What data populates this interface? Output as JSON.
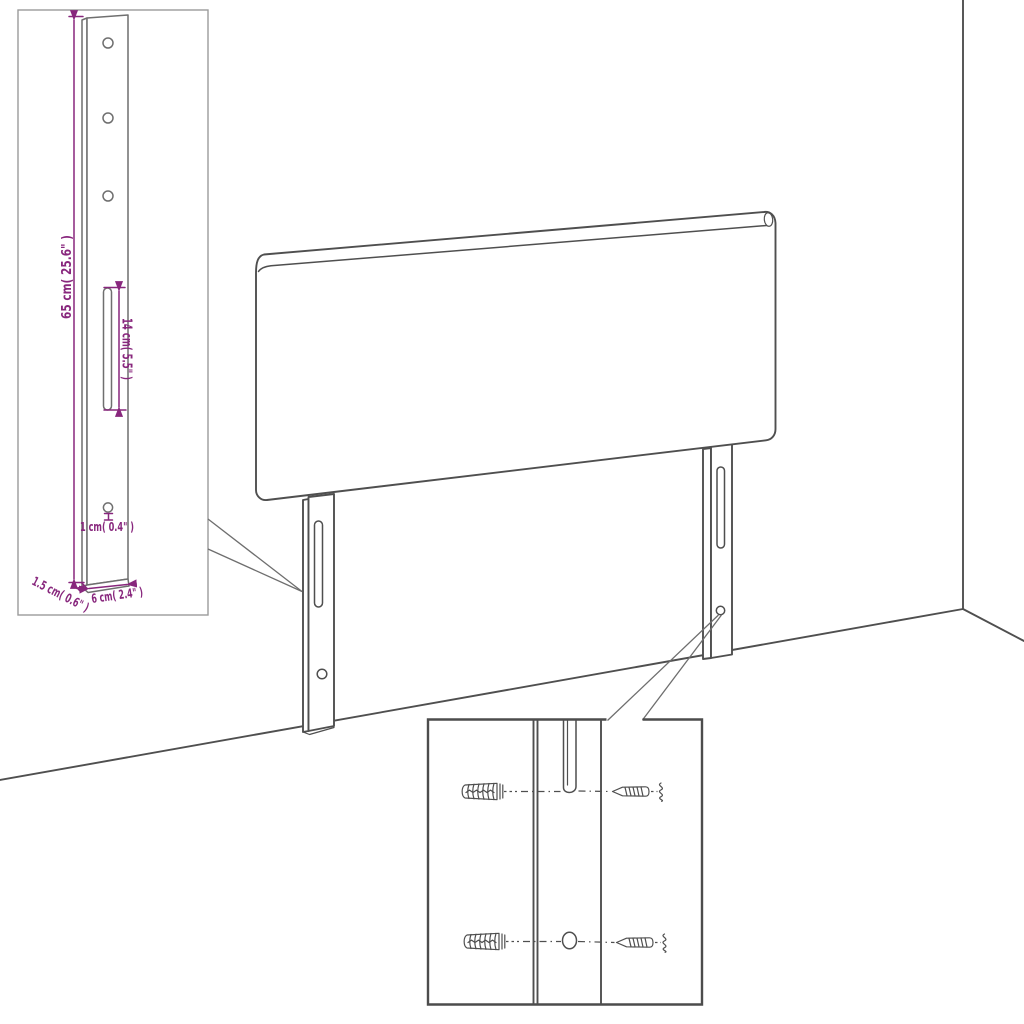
{
  "diagram": {
    "subject": "headboard-wall-mounting-instruction-diagram",
    "labels": {
      "bracket_height": "65 cm( 25.6\" )",
      "slot_length": "14 cm( 5.5\" )",
      "hole_diameter": "1 cm( 0.4\" )",
      "bracket_thickness": "1.5 cm( 0.6\" )",
      "bracket_width": "6 cm( 2.4\" )"
    },
    "colors": {
      "line": "#4f4f4f",
      "bracket_line": "#6f6f6f",
      "dimension": "#88277d",
      "inset1_border": "#9b9b9b",
      "inset2_border": "#4c4c4c",
      "background": "#ffffff"
    }
  }
}
